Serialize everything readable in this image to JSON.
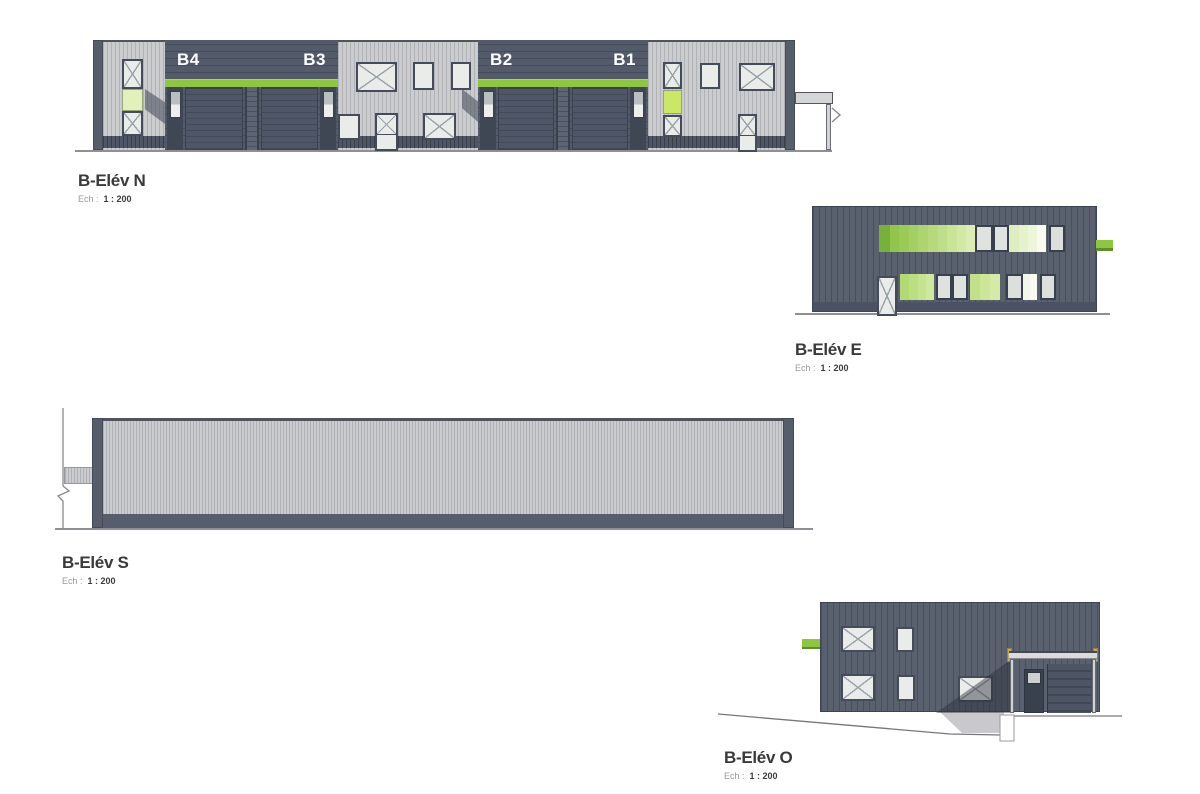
{
  "sheet": {
    "background": "#ffffff"
  },
  "colors": {
    "accent_green": "#8dc63f",
    "bright_green_pane": "#cbe768",
    "pale_green_pane": "#e2f1ba",
    "light_wall": "#cbccce",
    "dark_wall": "#59616f",
    "bay_wall": "#535b6a",
    "base_strip": "#4f5766",
    "window_frame": "#454c59",
    "window_pane": "#e9ece9",
    "ground_line": "#8f9095",
    "label_text": "#3a3a3a",
    "bay_label_text": "#ffffff"
  },
  "elevations": {
    "north": {
      "title": "B-Elév N",
      "scale_label": "Ech :",
      "scale_value": "1 : 200",
      "bay_labels": [
        "B4",
        "B3",
        "B2",
        "B1"
      ]
    },
    "east": {
      "title": "B-Elév E",
      "scale_label": "Ech :",
      "scale_value": "1 : 200"
    },
    "south": {
      "title": "B-Elév S",
      "scale_label": "Ech :",
      "scale_value": "1 : 200"
    },
    "west": {
      "title": "B-Elév O",
      "scale_label": "Ech :",
      "scale_value": "1 : 200"
    }
  },
  "east_windows": {
    "upper_band": [
      {
        "c": "#76b23a",
        "w": 11
      },
      {
        "c": "#92c54c",
        "w": 10
      },
      {
        "c": "#9bca57",
        "w": 10
      },
      {
        "c": "#a4cf63",
        "w": 10
      },
      {
        "c": "#add46f",
        "w": 10
      },
      {
        "c": "#b6d97c",
        "w": 10
      },
      {
        "c": "#bfde89",
        "w": 10
      },
      {
        "c": "#c9e397",
        "w": 10
      },
      {
        "c": "#d2e8a5",
        "w": 10
      },
      {
        "c": "#dbedb3",
        "w": 9
      },
      {
        "c": "#dfe3e0",
        "w": 18,
        "x": 1,
        "f": 1
      },
      {
        "c": "#dfe3e0",
        "w": 17,
        "x": 1,
        "f": 1
      },
      {
        "c": "#dfeec0",
        "w": 10
      },
      {
        "c": "#e6f2cc",
        "w": 10
      },
      {
        "c": "#edf6d8",
        "w": 9
      },
      {
        "c": "#f9fbef",
        "w": 9
      },
      {
        "w": 4
      },
      {
        "c": "#dce0dd",
        "w": 16,
        "f": 1
      }
    ],
    "lower_band": [
      {
        "c": "#b2d973",
        "w": 9
      },
      {
        "c": "#bcde82",
        "w": 9
      },
      {
        "c": "#c6e391",
        "w": 8
      },
      {
        "c": "#cfe8a0",
        "w": 8
      },
      {
        "w": 2
      },
      {
        "c": "#dfe3e0",
        "w": 16,
        "x": 1,
        "f": 1
      },
      {
        "c": "#dfe3e0",
        "w": 16,
        "x": 1,
        "f": 1
      },
      {
        "w": 2
      },
      {
        "c": "#c2e089",
        "w": 10
      },
      {
        "c": "#cce597",
        "w": 10
      },
      {
        "c": "#d5eaa6",
        "w": 10
      },
      {
        "w": 6
      },
      {
        "c": "#dce0dd",
        "w": 17,
        "f": 1
      },
      {
        "c": "#f2f6e7",
        "w": 7
      },
      {
        "c": "#f8faf0",
        "w": 7
      },
      {
        "w": 3
      },
      {
        "c": "#dce0dd",
        "w": 16,
        "f": 1
      }
    ]
  }
}
